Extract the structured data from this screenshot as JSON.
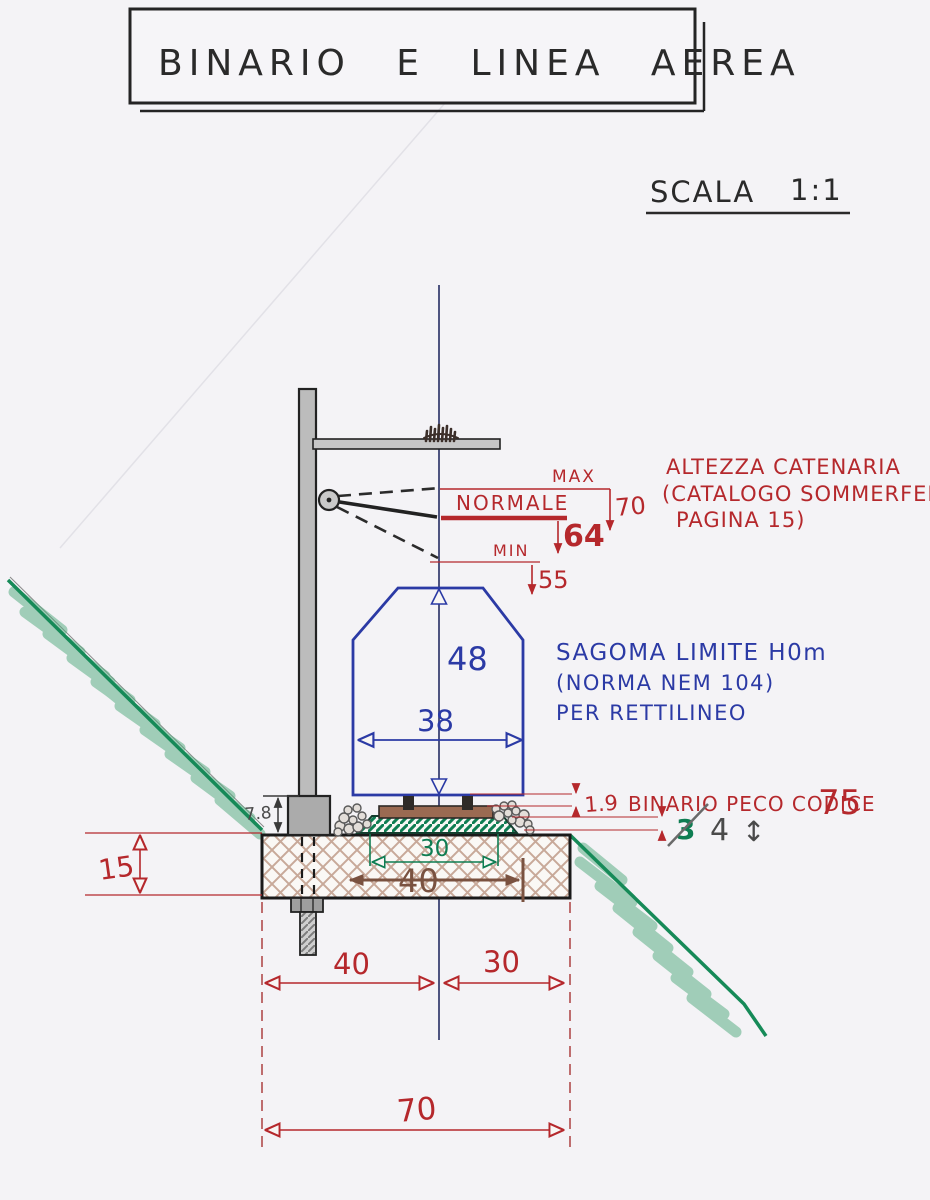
{
  "title": "BINARIO E LINEA AEREA",
  "scale": {
    "label": "SCALA",
    "ratio": "1:1"
  },
  "catenary": {
    "note": [
      "ALTEZZA CATENARIA",
      "(CATALOGO SOMMERFELDT",
      "PAGINA 15)"
    ],
    "max_label": "MAX",
    "max_height": "70",
    "normal_label": "NORMALE",
    "normal_height": "64",
    "min_label": "MIN",
    "min_height": "55"
  },
  "gauge": {
    "height": "48",
    "width": "38",
    "note": [
      "SAGOMA LIMITE H0m",
      "(NORMA NEM 104)",
      "PER RETTILINEO"
    ]
  },
  "track": {
    "rail_height": "1.9",
    "rail_label": "BINARIO PECO CODICE",
    "rail_code": "75",
    "underlay_old_value": "3",
    "underlay_value": "4",
    "updown_arrow": "↕"
  },
  "bed": {
    "depth": "15",
    "mast_base_height": "7.8",
    "underlay_width": "30",
    "ballast_top_width": "40",
    "left_half_width": "40",
    "right_half_width": "30",
    "total_width": "70"
  },
  "colors": {
    "paper": "#f4f3f6",
    "ink_black": "#2a2a2a",
    "ink_red": "#b5282c",
    "ink_blue": "#2b3aa5",
    "ink_green": "#0e7d52",
    "slope_green": "#168a58",
    "centerline_navy": "#3b4273",
    "sand_brown": "#b78f7a",
    "dim_brown": "#7a5240",
    "pencil_gray": "#4a4a4a",
    "mast_gray": "#bcbcbc"
  }
}
